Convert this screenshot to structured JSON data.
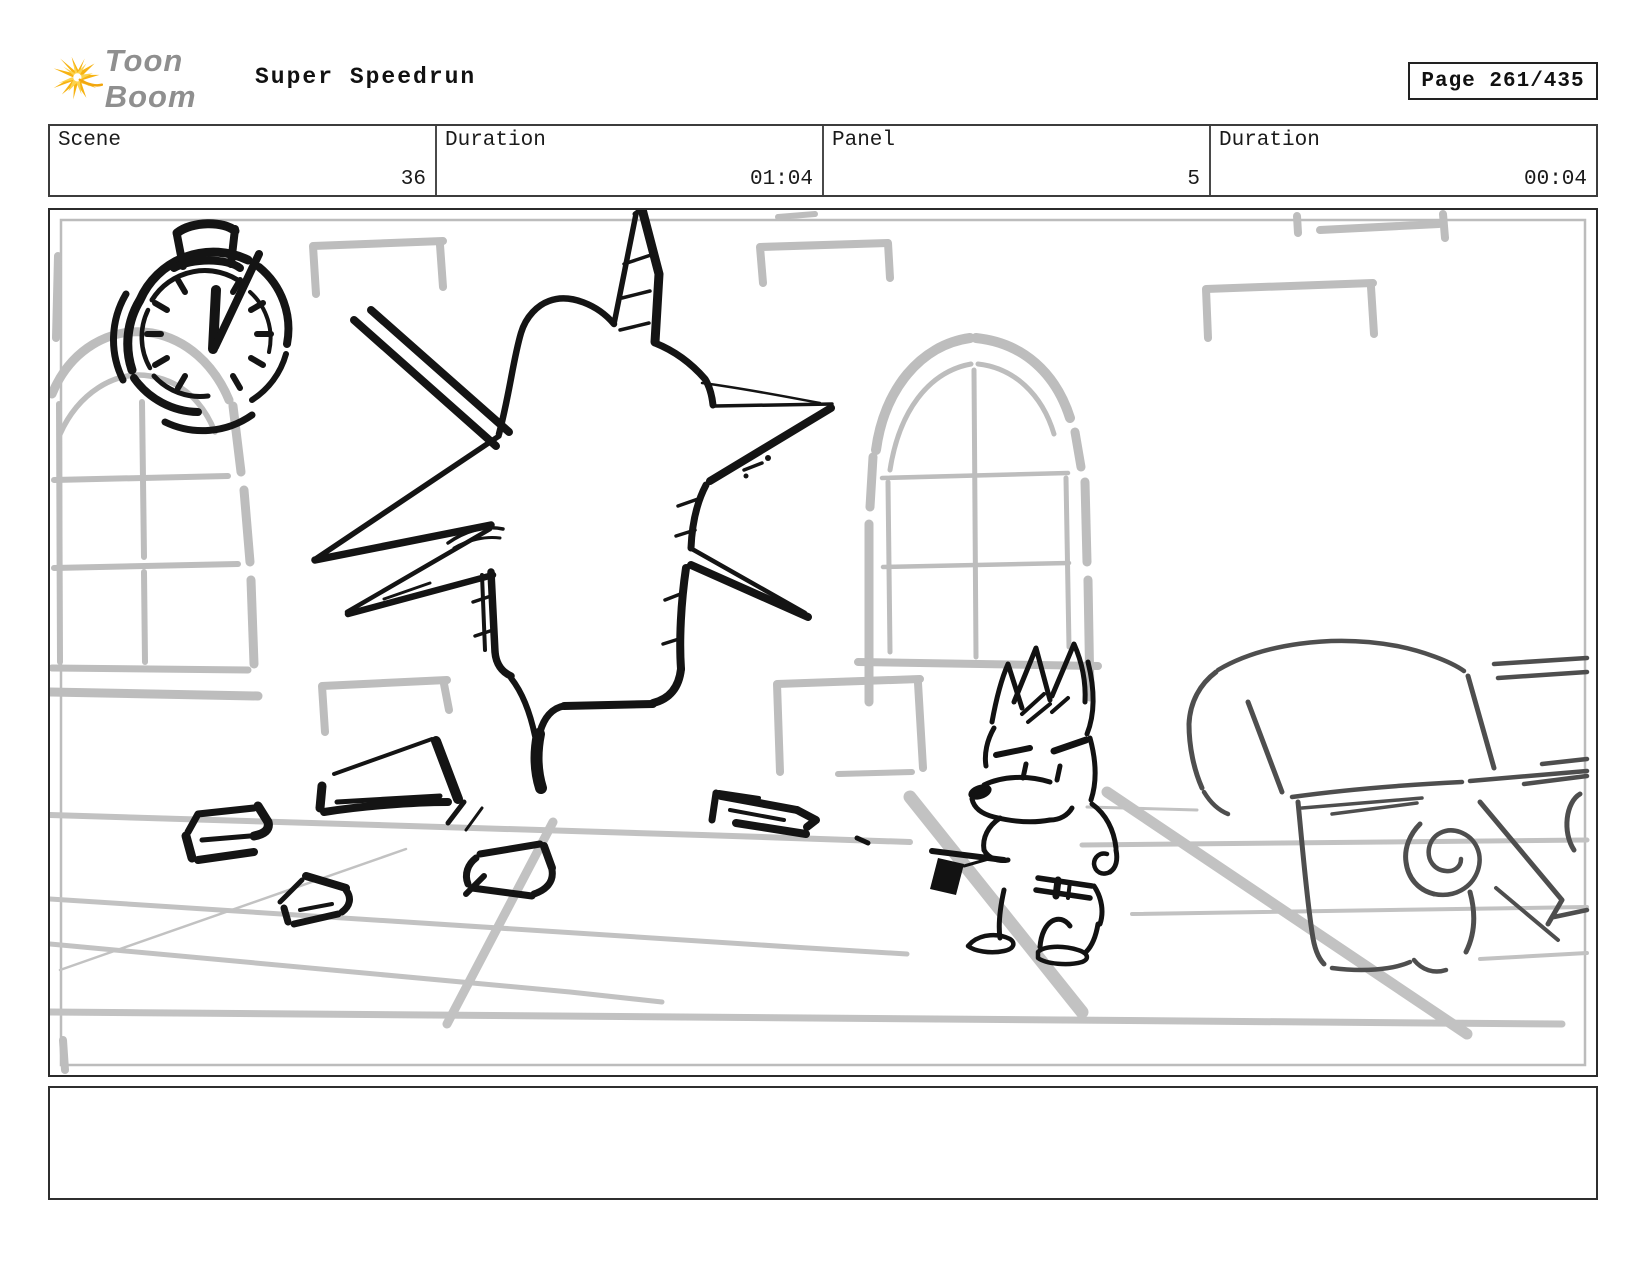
{
  "header": {
    "brand": "Toon Boom",
    "logo_icon": "toonboom-starburst-icon",
    "title": "Super Speedrun",
    "page_label": "Page 261/435"
  },
  "info_row": {
    "cells": [
      {
        "label": "Scene",
        "value": "36"
      },
      {
        "label": "Duration",
        "value": "01:04"
      },
      {
        "label": "Panel",
        "value": "5"
      },
      {
        "label": "Duration",
        "value": "00:04"
      }
    ]
  },
  "storyboard": {
    "drawing": "sketch: stopwatch on wall, star-shaped hole in brick wall, two arched windows, angry cartoon fox holding mallet, armchair, debris on perspective floor",
    "caption": ""
  },
  "colors": {
    "sketch_black": "#141414",
    "wall_gray": "#bdbdbd",
    "floor_gray": "#c2c2c2",
    "chair_gray": "#4e4e4e",
    "logo_yellow": "#f7b312",
    "brand_gray": "#8f8f8f"
  }
}
